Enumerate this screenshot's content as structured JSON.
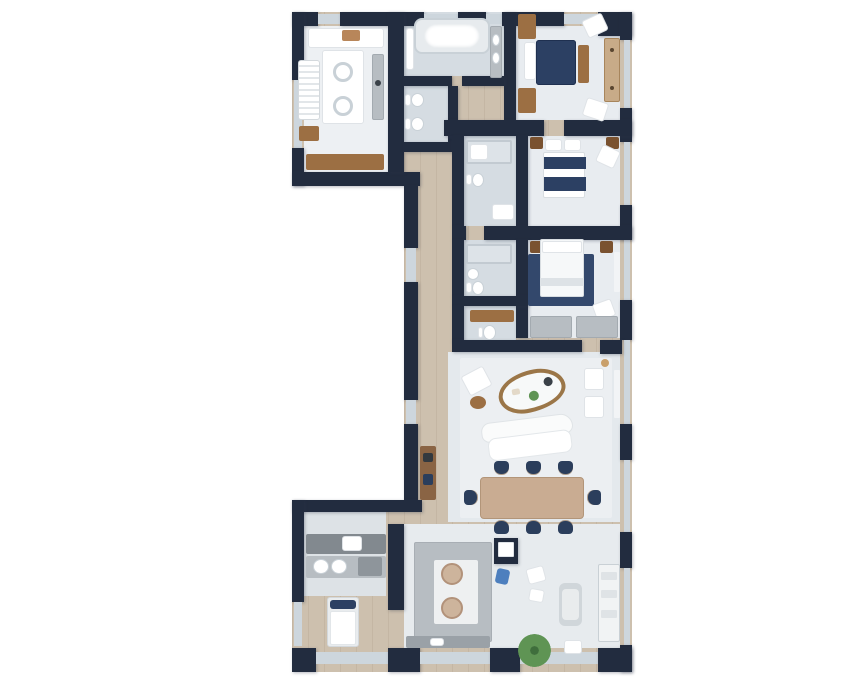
{
  "plan": {
    "type": "apartment-floor-plan-top-view",
    "rooms": [
      "utility-room",
      "master-bathroom",
      "wc",
      "master-bedroom",
      "bedroom-2",
      "ensuite-2",
      "bedroom-3",
      "ensuite-3",
      "guest-wc",
      "walk-in-closet",
      "hallway",
      "living-dining-room",
      "kitchen",
      "laundry-room",
      "staff-room",
      "terrace"
    ],
    "counts": {
      "dining_chairs": 8,
      "beds": 4,
      "bathtubs": 1
    }
  },
  "colors": {
    "wall": "#222c3f",
    "wood": "#cdc0ae",
    "glass": "#cdd6dd",
    "floor_utility": "#edf0f3",
    "floor_bath": "#d5dce2",
    "floor_bedroom": "#e8ecf0",
    "floor_living": "#e4e9ed",
    "floor_kitchen": "#e7ebee",
    "floor_laundry": "#dde2e6",
    "rug": "#eceff2",
    "rug_navy": "#33486c",
    "bed_navy": "#2c4063",
    "chair_navy": "#2b3e5c",
    "wood_furniture": "#9c6f43",
    "wood_light": "#c8ab88",
    "tan_table": "#c9ac92",
    "counter_gray": "#b7bdc2",
    "counter_dark": "#82898f",
    "steel": "#9aa1a7",
    "cooktop": "#cdb49c",
    "plant_green": "#5f9454",
    "plant_dark": "#3f6e3c",
    "accent_blue": "#4d7fbe",
    "white": "#ffffff"
  }
}
